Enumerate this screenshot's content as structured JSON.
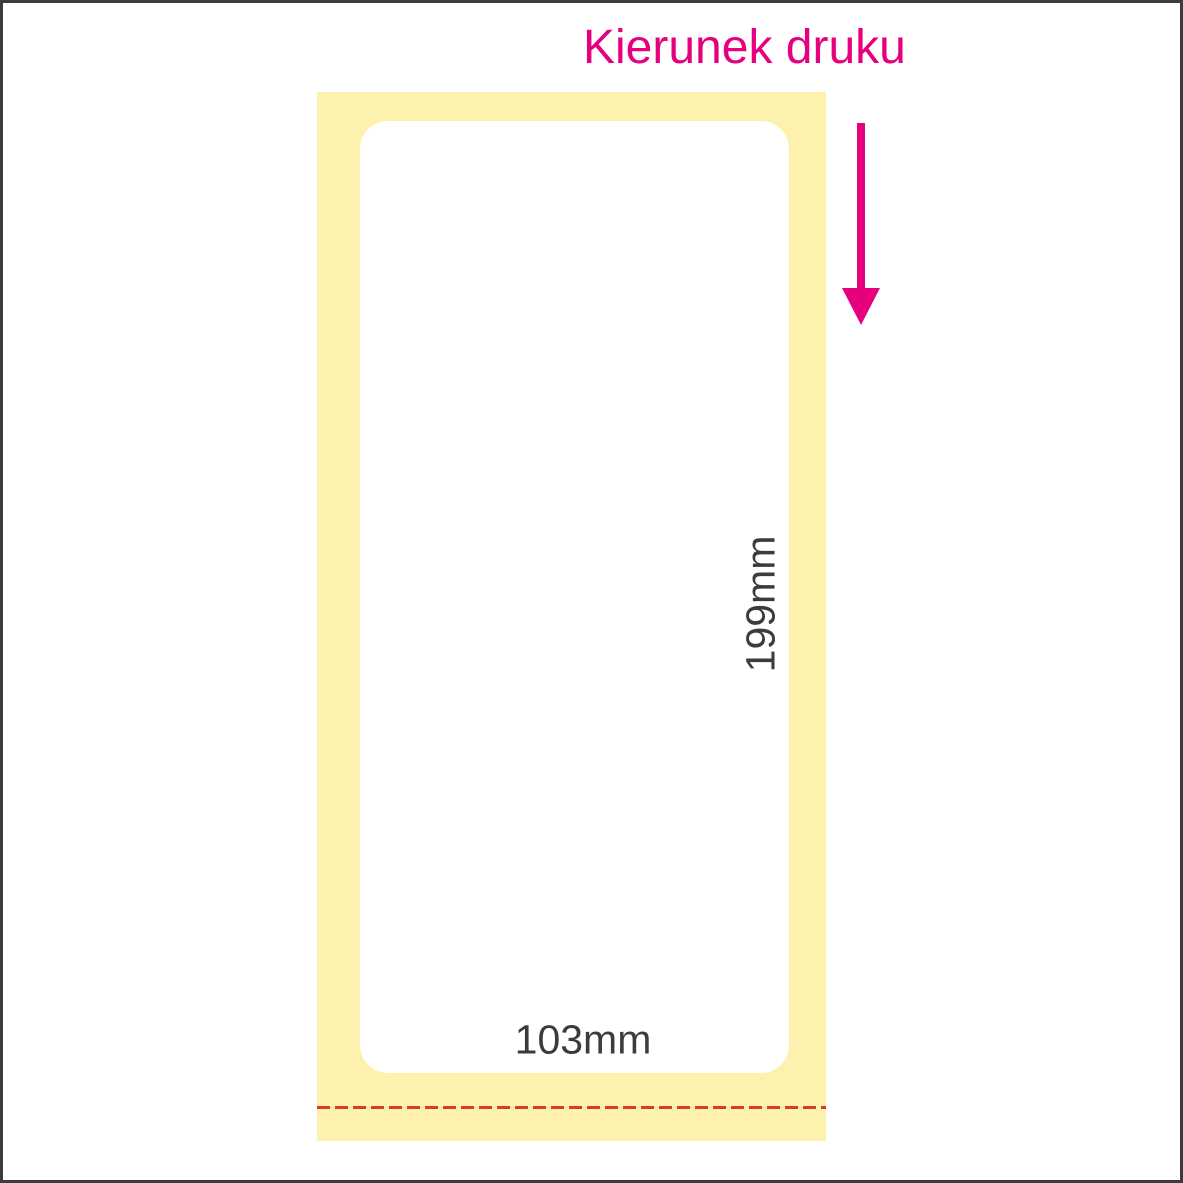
{
  "title": "Kierunek druku",
  "label": {
    "height_label": "199mm",
    "width_label": "103mm"
  },
  "icons": {
    "print_direction_arrow": "down-arrow"
  },
  "colors": {
    "magenta": "#E6007E",
    "liner_yellow": "#FCF2AD",
    "perforation_red": "#DC3732",
    "ink": "#3C3C3B",
    "paper": "#FFFFFF"
  }
}
